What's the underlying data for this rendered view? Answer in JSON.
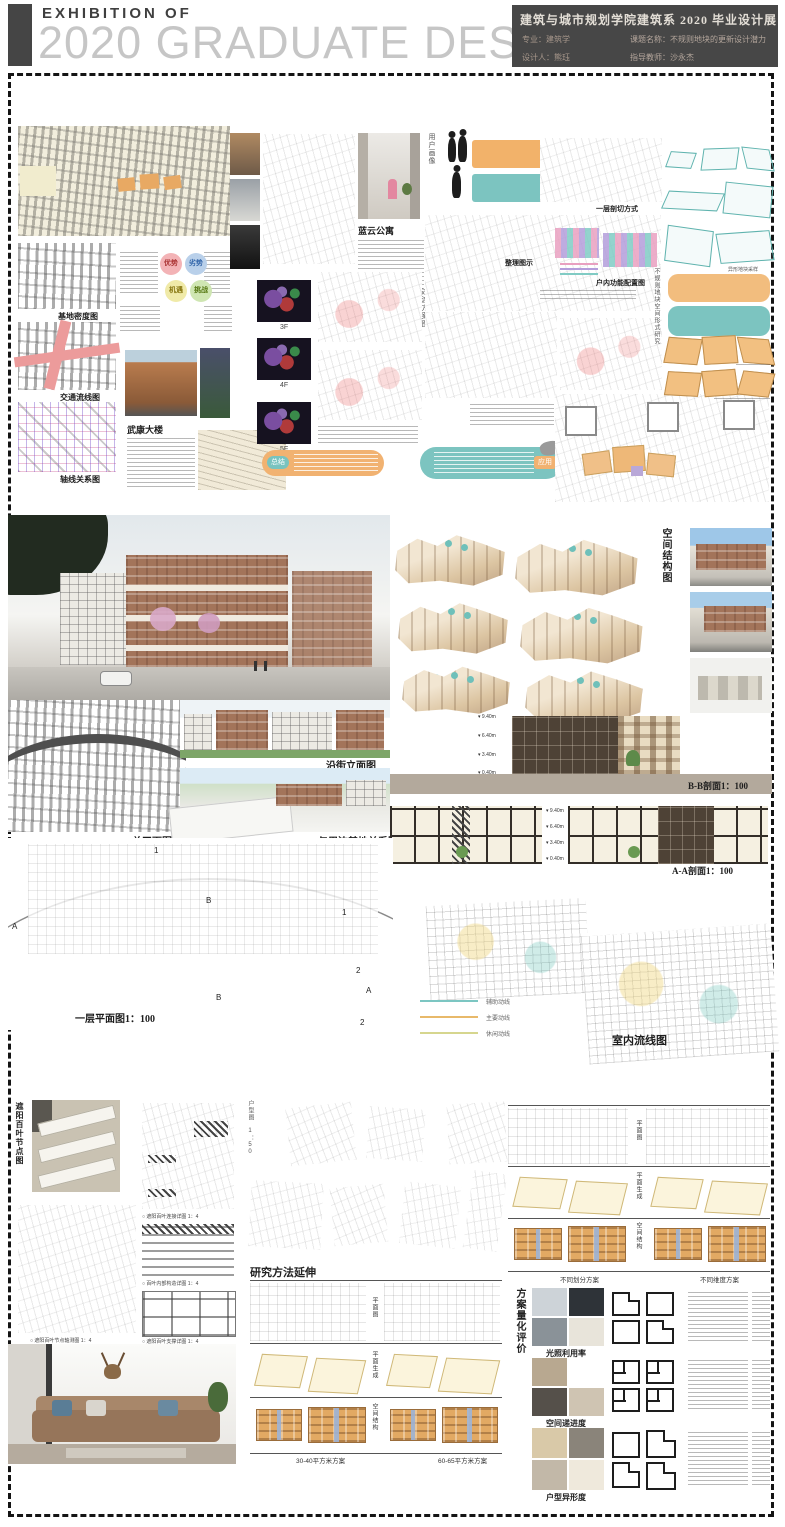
{
  "header": {
    "eyebrow": "EXHIBITION OF",
    "title": "2020 GRADUATE DESIGN",
    "info": {
      "title": "建筑与城市规划学院建筑系 2020 毕业设计展",
      "major": "专业：建筑学",
      "project": "课题名称：不规则地块的更新设计潜力",
      "designer": "设计人：熊珏",
      "advisor": "指导教师：沙永杰"
    }
  },
  "colors": {
    "accent_orange": "#f0ab63",
    "accent_teal": "#76c2bd",
    "brick": "#a3745a",
    "header_bg": "#474747",
    "legend_teal": "#7cc6c2",
    "legend_orange": "#e8b96a",
    "legend_khaki": "#d6d68e"
  },
  "top": {
    "maps": {
      "density": "基地密度图",
      "traffic": "交通流线图",
      "axis": "轴线关系图"
    },
    "swot": {
      "s": "优势",
      "w": "劣势",
      "o": "机遇",
      "t": "挑战"
    },
    "wukang_title": "武康大楼",
    "apartment_label": "蓝云公寓",
    "user_profile": "用户画像",
    "floors": [
      "3F",
      "4F",
      "5F"
    ],
    "transition_label": "过渡方案图",
    "summary_pill": "总结",
    "apply_pill": "应用",
    "section_mode_label": "一层剖切方式",
    "sort_label": "整理图示",
    "interior_config_label": "户内功能配置图",
    "plot_study_vertical": "不规则地块空间形式研究",
    "plot_sample_caption": "异形地块采样"
  },
  "middle": {
    "spatial_structure": "空间结构图",
    "street_elevation": "沿街立面图",
    "master_plan": "总平面图",
    "context_relation": "与周边基地关系图",
    "section_bb": "B-B剖面1：100",
    "section_aa": "A-A剖面1：100",
    "levels": [
      "9.40m",
      "6.40m",
      "3.40m",
      "0.40m"
    ],
    "first_floor_plan": "一层平面图1：100",
    "legend": [
      {
        "label": "辅助动线",
        "color": "#7cc6c2"
      },
      {
        "label": "主要动线",
        "color": "#e8b96a"
      },
      {
        "label": "休闲动线",
        "color": "#d6d68e"
      }
    ],
    "interior_circulation": "室内流线图",
    "plan_marks": [
      {
        "t": "1"
      },
      {
        "t": "B"
      },
      {
        "t": "1"
      },
      {
        "t": "A"
      },
      {
        "t": "2"
      },
      {
        "t": "B"
      },
      {
        "t": "A"
      },
      {
        "t": "2"
      }
    ]
  },
  "bottom": {
    "louver_node_vertical": "遮阳百叶节点图",
    "louver_captions": [
      "○ 遮阳百叶节点轴测图 1：4",
      "○ 遮阳百叶连接详图 1：4",
      "○ 百叶内部构造详图 1：4",
      "○ 遮阳百叶支撑详图 1：4"
    ],
    "unit_plan_vertical": "户型图 1：50",
    "method_heading": "研究方法延伸",
    "row_labels": [
      "平面图",
      "平面生成",
      "空间结构"
    ],
    "scheme_captions": {
      "a": "30-40平方米方案",
      "b": "60-65平方米方案",
      "c": "不同划分方案",
      "d": "不同维度方案"
    },
    "eval_vertical": "方案量化评价",
    "eval_rows": [
      "光照利用率",
      "空间递进度",
      "户型异形度"
    ]
  }
}
